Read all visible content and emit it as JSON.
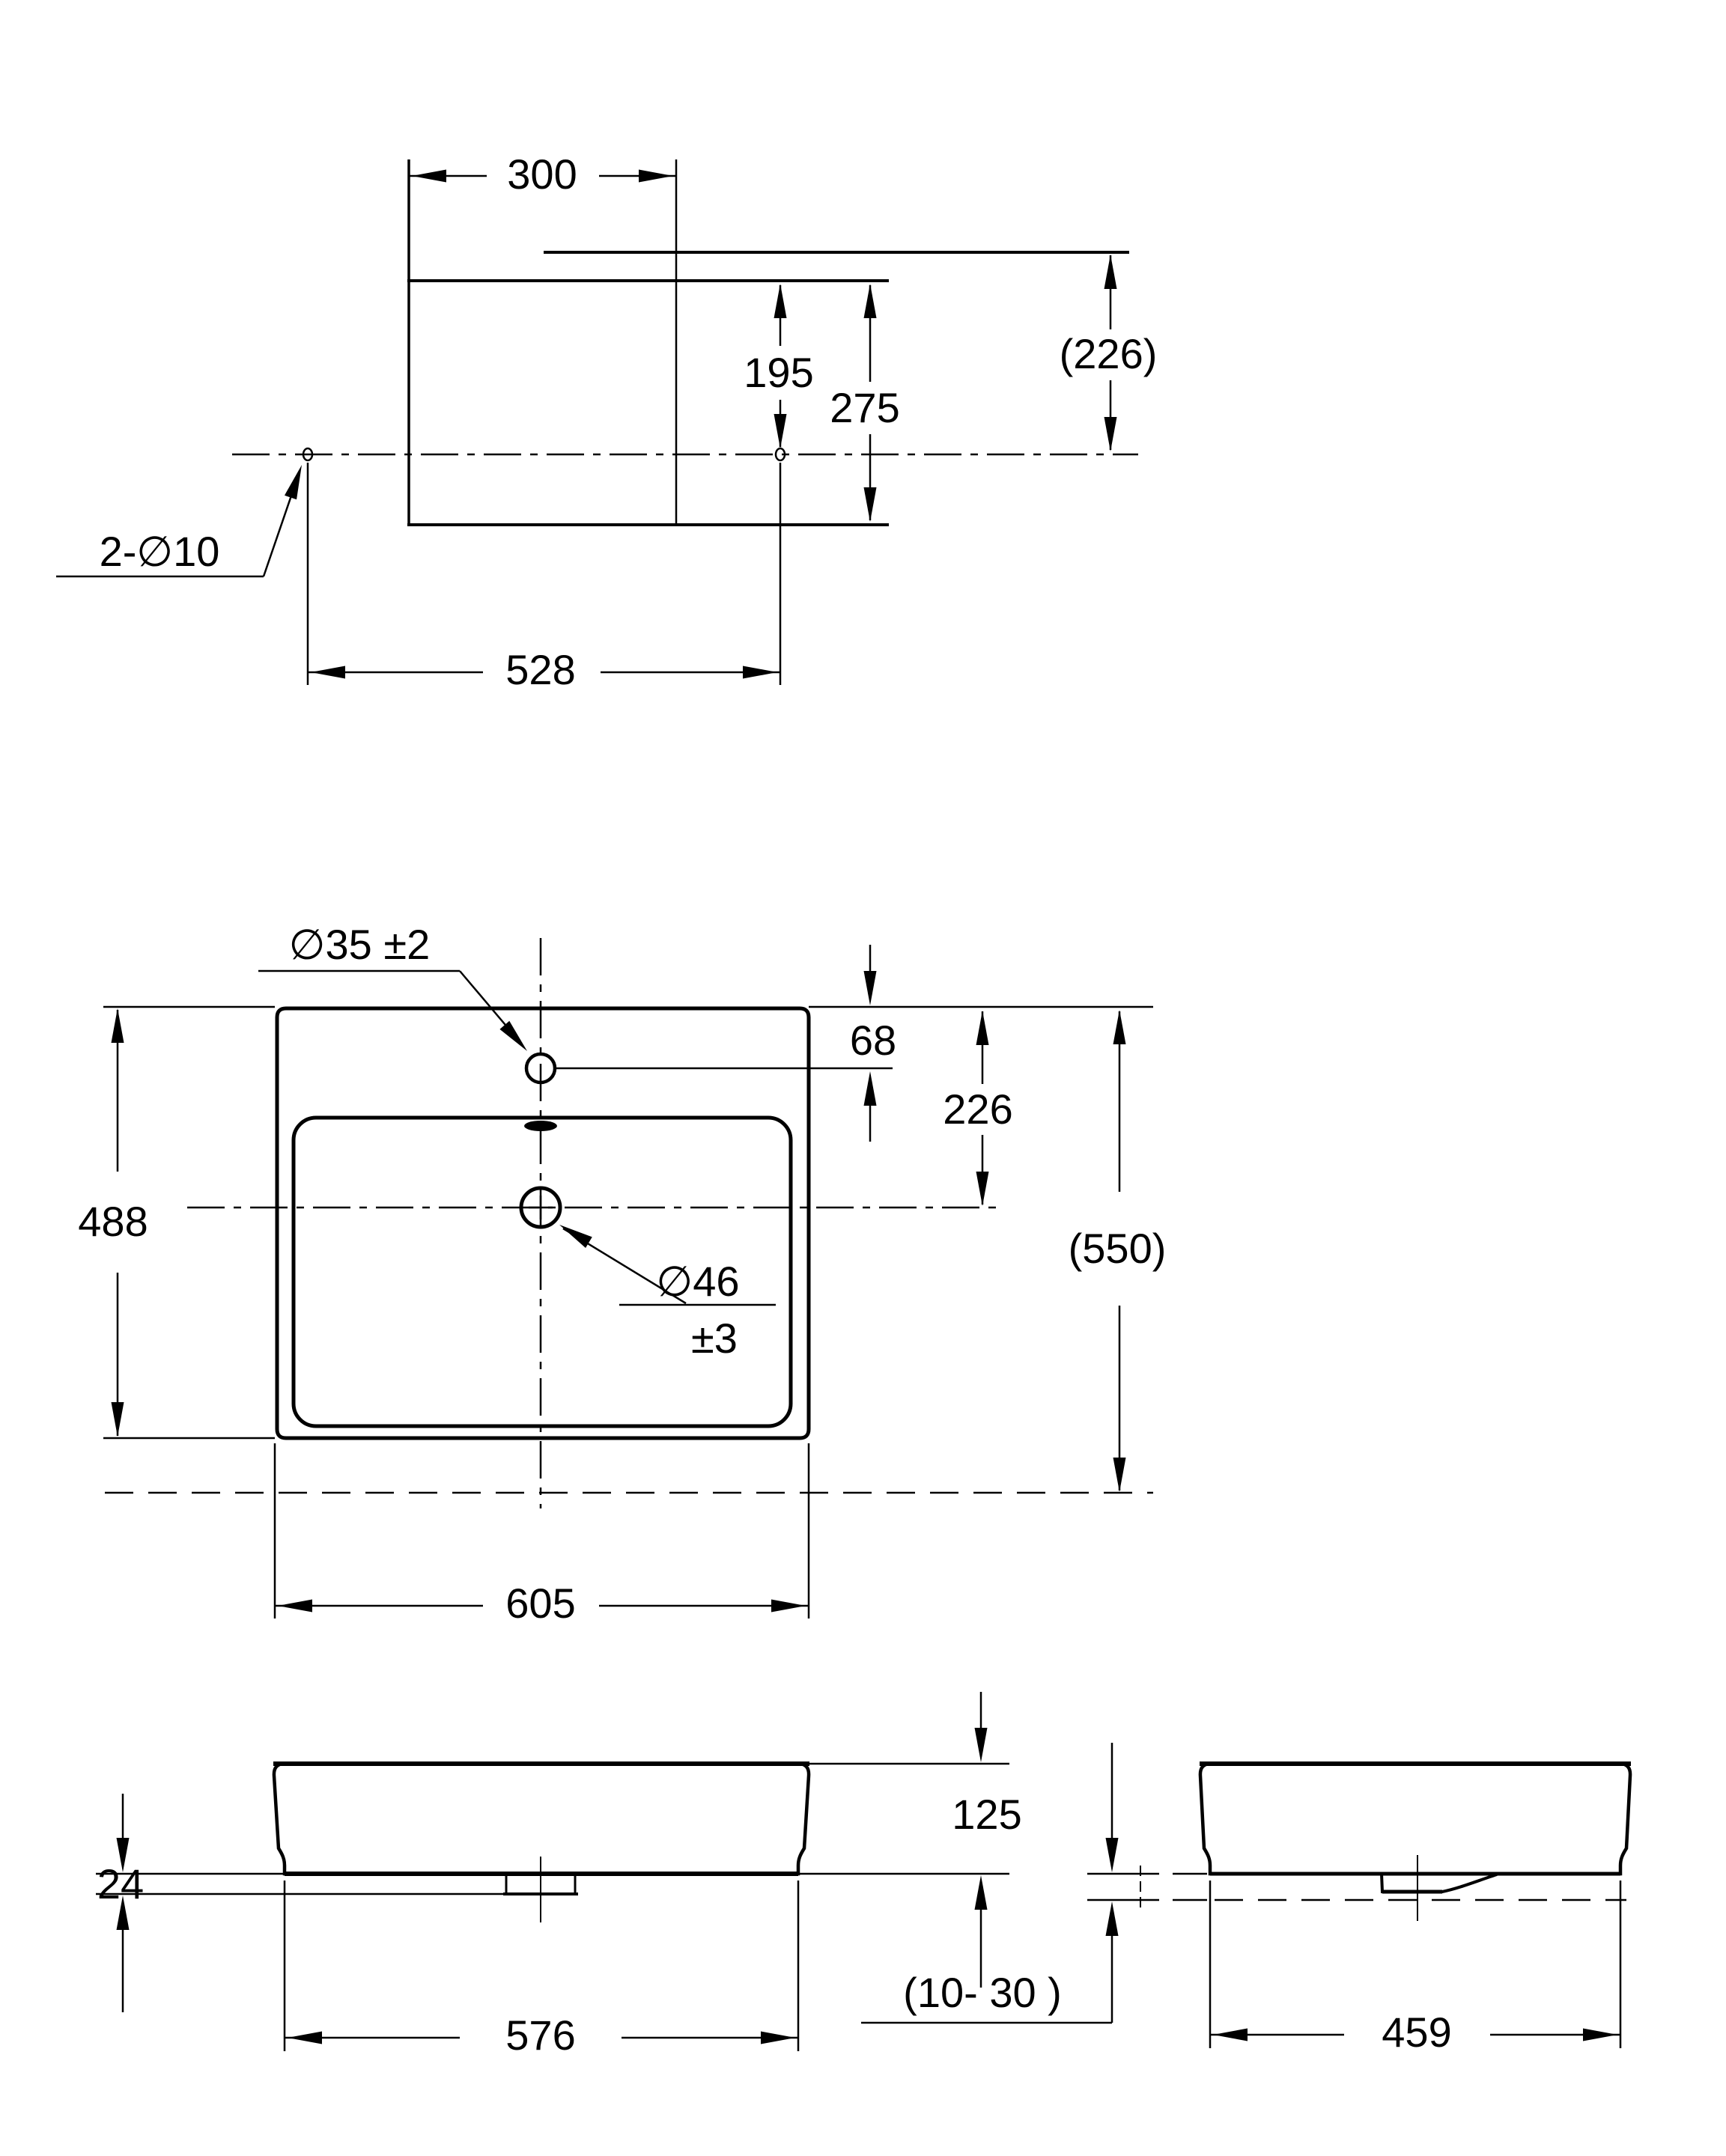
{
  "page": {
    "background": "#ffffff",
    "line_color": "#000000",
    "kind": "washbasin installation dimension drawing"
  },
  "labels": {
    "top_view": {
      "w300": "300",
      "h195": "195",
      "h275": "275",
      "h226": "(226)",
      "holes": "2-∅10",
      "w528": "528"
    },
    "plan_view": {
      "faucet": "∅35 ±2",
      "o68": "68",
      "o226": "226",
      "d488": "488",
      "d550": "(550)",
      "drain": "∅46",
      "drain_tol": "±3",
      "w605": "605"
    },
    "front_view": {
      "h125": "125",
      "h24": "24",
      "w576": "576",
      "range1030": "(10- 30 )"
    },
    "side_view": {
      "w459": "459"
    }
  }
}
